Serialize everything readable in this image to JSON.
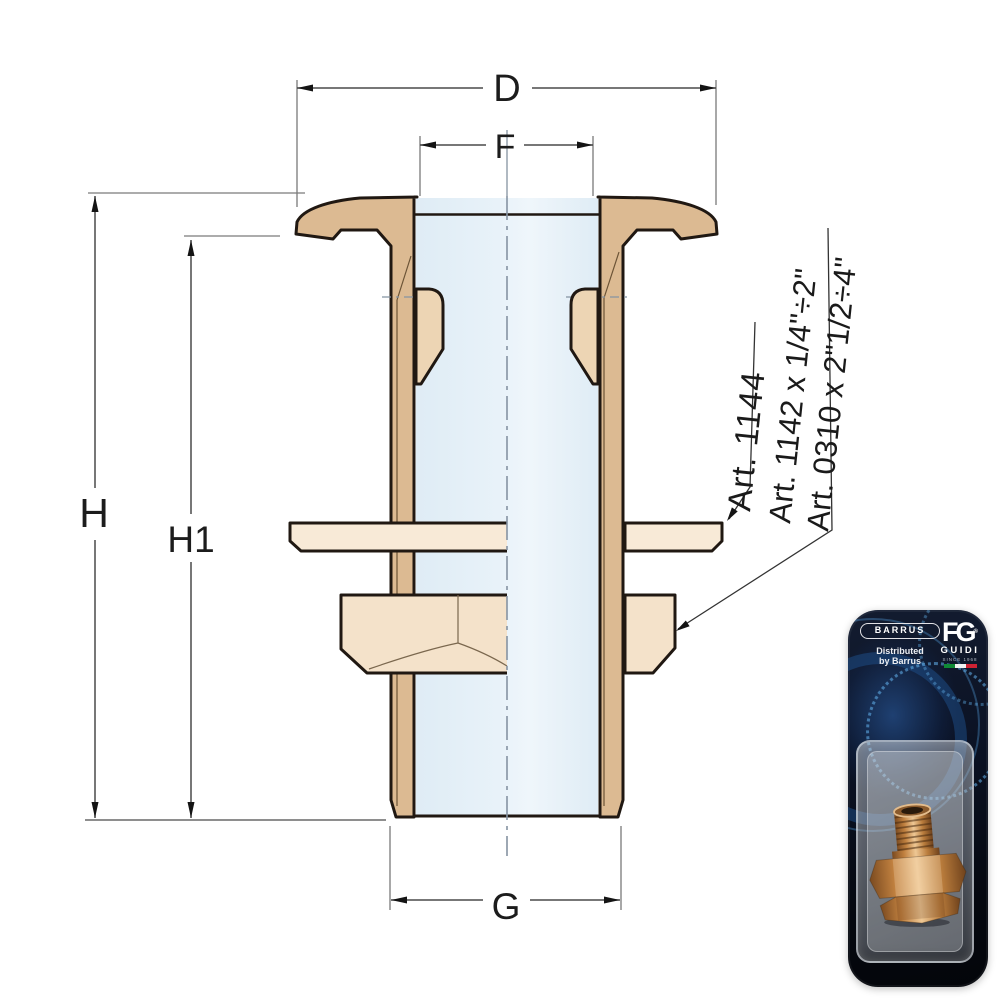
{
  "drawing": {
    "dim_labels": {
      "D": "D",
      "F": "F",
      "G": "G",
      "H": "H",
      "H1": "H1"
    },
    "annotations": {
      "art_1144": "Art. 1144",
      "art_1142": "Art. 1142 x 1/4\"÷2\"",
      "art_0310": "Art. 0310 x 2\"1/2÷4\""
    },
    "colors": {
      "bronze": "#dcba92",
      "bronze_light": "#edd5b4",
      "washer": "#f8ead7",
      "nut": "#f4e2ca",
      "bore_blue": "#e8f2f9",
      "outline": "#201812",
      "centerline": "#8593a2"
    }
  },
  "packaging": {
    "brand_badge": "BARRUS",
    "distributed_1": "Distributed",
    "distributed_2": "by Barrus",
    "monogram": "FG",
    "registered": "®",
    "brand_name": "GUIDI",
    "tagline": "SINCE 1968",
    "flag_colors": [
      "#108a36",
      "#f2f2f2",
      "#cf2233"
    ]
  }
}
